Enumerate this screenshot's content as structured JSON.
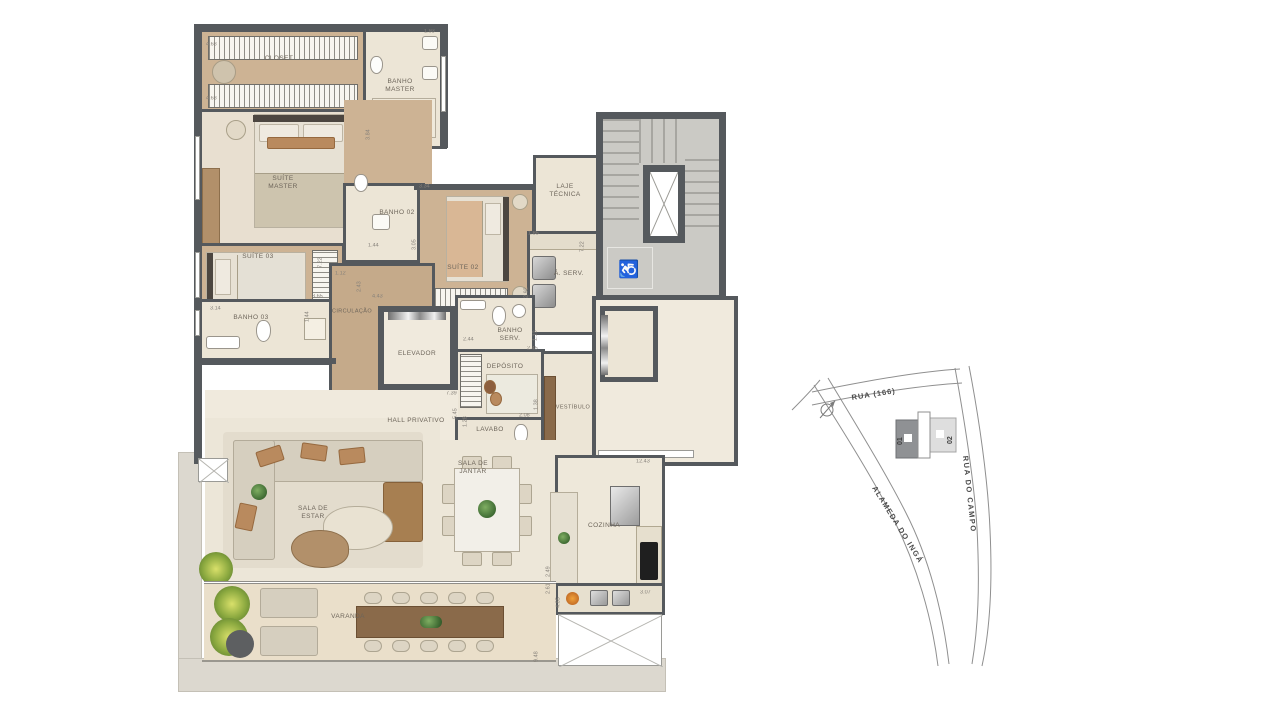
{
  "floorplan": {
    "rooms": {
      "closet": "CLOSET",
      "banho_master": "BANHO\nMASTER",
      "suite_master": "SUÍTE\nMASTER",
      "suite_03": "SUÍTE 03",
      "banho_02": "BANHO 02",
      "suite_02": "SUÍTE 02",
      "laje_tecnica": "LAJE\nTÉCNICA",
      "a_serv": "Á. SERV.",
      "banho_03": "BANHO 03",
      "circulacao": "CIRCULAÇÃO",
      "elevador": "ELEVADOR",
      "banho_serv": "BANHO\nSERV.",
      "deposito": "DEPÓSITO",
      "hall_privativo": "HALL PRIVATIVO",
      "lavabo": "LAVABO",
      "vestibulo": "VESTÍBULO",
      "sala_estar": "SALA DE\nESTAR",
      "sala_jantar": "SALA DE\nJANTAR",
      "cozinha": "COZINHA",
      "varanda": "VARANDA"
    },
    "dimensions": [
      {
        "t": "4.68",
        "x": 206,
        "y": 42
      },
      {
        "t": "1.93",
        "x": 424,
        "y": 29
      },
      {
        "t": "4.68",
        "x": 206,
        "y": 96
      },
      {
        "t": "3.84",
        "x": 366,
        "y": 140,
        "v": 1
      },
      {
        "t": "3.34",
        "x": 419,
        "y": 184
      },
      {
        "t": "1.44",
        "x": 368,
        "y": 243
      },
      {
        "t": "3.05",
        "x": 412,
        "y": 250,
        "v": 1
      },
      {
        "t": "7.22",
        "x": 318,
        "y": 268,
        "v": 1
      },
      {
        "t": "1.12",
        "x": 335,
        "y": 271
      },
      {
        "t": "2.43",
        "x": 357,
        "y": 292,
        "v": 1
      },
      {
        "t": "3.65",
        "x": 312,
        "y": 294
      },
      {
        "t": "4.43",
        "x": 372,
        "y": 294
      },
      {
        "t": "3.14",
        "x": 210,
        "y": 306
      },
      {
        "t": "1.44",
        "x": 305,
        "y": 322,
        "v": 1
      },
      {
        "t": "1.85",
        "x": 528,
        "y": 231
      },
      {
        "t": "7.22",
        "x": 580,
        "y": 252,
        "v": 1
      },
      {
        "t": "2.92",
        "x": 524,
        "y": 298,
        "v": 1
      },
      {
        "t": "2.44",
        "x": 463,
        "y": 337
      },
      {
        "t": "1.13",
        "x": 533,
        "y": 341,
        "v": 1
      },
      {
        "t": "2.45",
        "x": 527,
        "y": 346
      },
      {
        "t": "7.39",
        "x": 446,
        "y": 391
      },
      {
        "t": "5.45",
        "x": 453,
        "y": 419,
        "v": 1
      },
      {
        "t": "1.28",
        "x": 463,
        "y": 427,
        "v": 1
      },
      {
        "t": "2.08",
        "x": 519,
        "y": 413
      },
      {
        "t": "1.38",
        "x": 534,
        "y": 410,
        "v": 1
      },
      {
        "t": "12.43",
        "x": 636,
        "y": 459
      },
      {
        "t": "2.49",
        "x": 546,
        "y": 577,
        "v": 1
      },
      {
        "t": "2.61",
        "x": 546,
        "y": 594,
        "v": 1
      },
      {
        "t": "4.85",
        "x": 556,
        "y": 608,
        "v": 1
      },
      {
        "t": "3.07",
        "x": 640,
        "y": 590
      },
      {
        "t": "9.48",
        "x": 534,
        "y": 662,
        "v": 1
      }
    ]
  },
  "map": {
    "street_top": "RUA (166)",
    "street_right": "RUA DO CAMPO",
    "street_diagonal": "ALAMEDA DO INGÁ",
    "unit_01": "01",
    "unit_02": "02"
  },
  "colors": {
    "wall": "#55595d",
    "wood_floor": "#cdb394",
    "tile_floor": "#ece5d6",
    "stair_gray": "#cbcac5",
    "terrace": "#dcd8cf",
    "map_unit01": "#8f9194",
    "map_unit02": "#dedede"
  }
}
